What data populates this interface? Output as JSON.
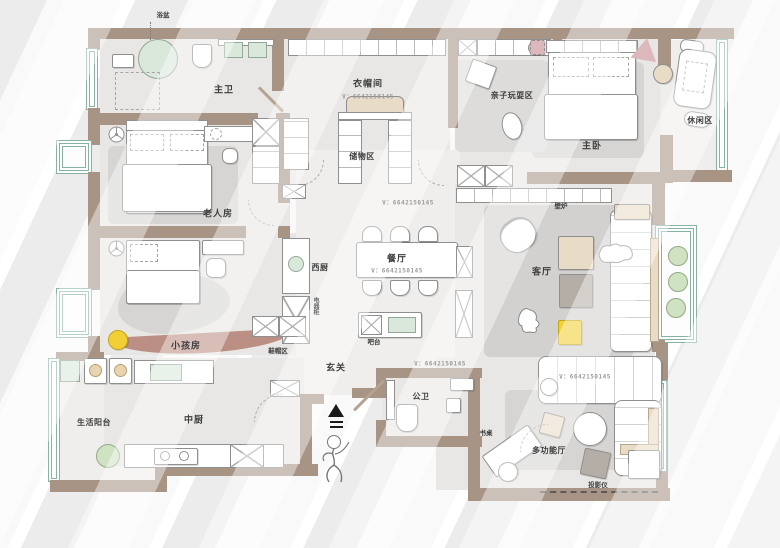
{
  "watermark": "V：6642150145",
  "labels": {
    "bathtub": "浴盆",
    "master_bath": "主卫",
    "cloakroom": "衣帽间",
    "storage_area": "储物区",
    "play_area": "亲子玩耍区",
    "master_bedroom": "主卧",
    "leisure_area": "休闲区",
    "elder_room": "老人房",
    "kids_room": "小孩房",
    "west_kitchen": "西厨",
    "appliance_cabinet": "电器柜",
    "dining_room": "餐厅",
    "bar_counter": "吧台",
    "shoe_area": "鞋帽区",
    "foyer": "玄关",
    "guest_bath": "公卫",
    "service_balcony": "生活阳台",
    "chinese_kitchen": "中厨",
    "living_room": "客厅",
    "fireplace": "壁炉",
    "multi_hall": "多功能厅",
    "desk": "书桌",
    "projector": "投影仪"
  },
  "colors": {
    "wall": "#a79484",
    "curved_wall": "#bb8f83",
    "floor": "#e8e7e5",
    "rug": "#d6d5d3",
    "window_green": "#86b2a2",
    "fixture_green": "#d9e8da",
    "plant_green": "#cfe3c2",
    "accent_beige": "#e9dcc6",
    "accent_yellow": "#f2cf35",
    "accent_pink": "#dcb8bd"
  }
}
